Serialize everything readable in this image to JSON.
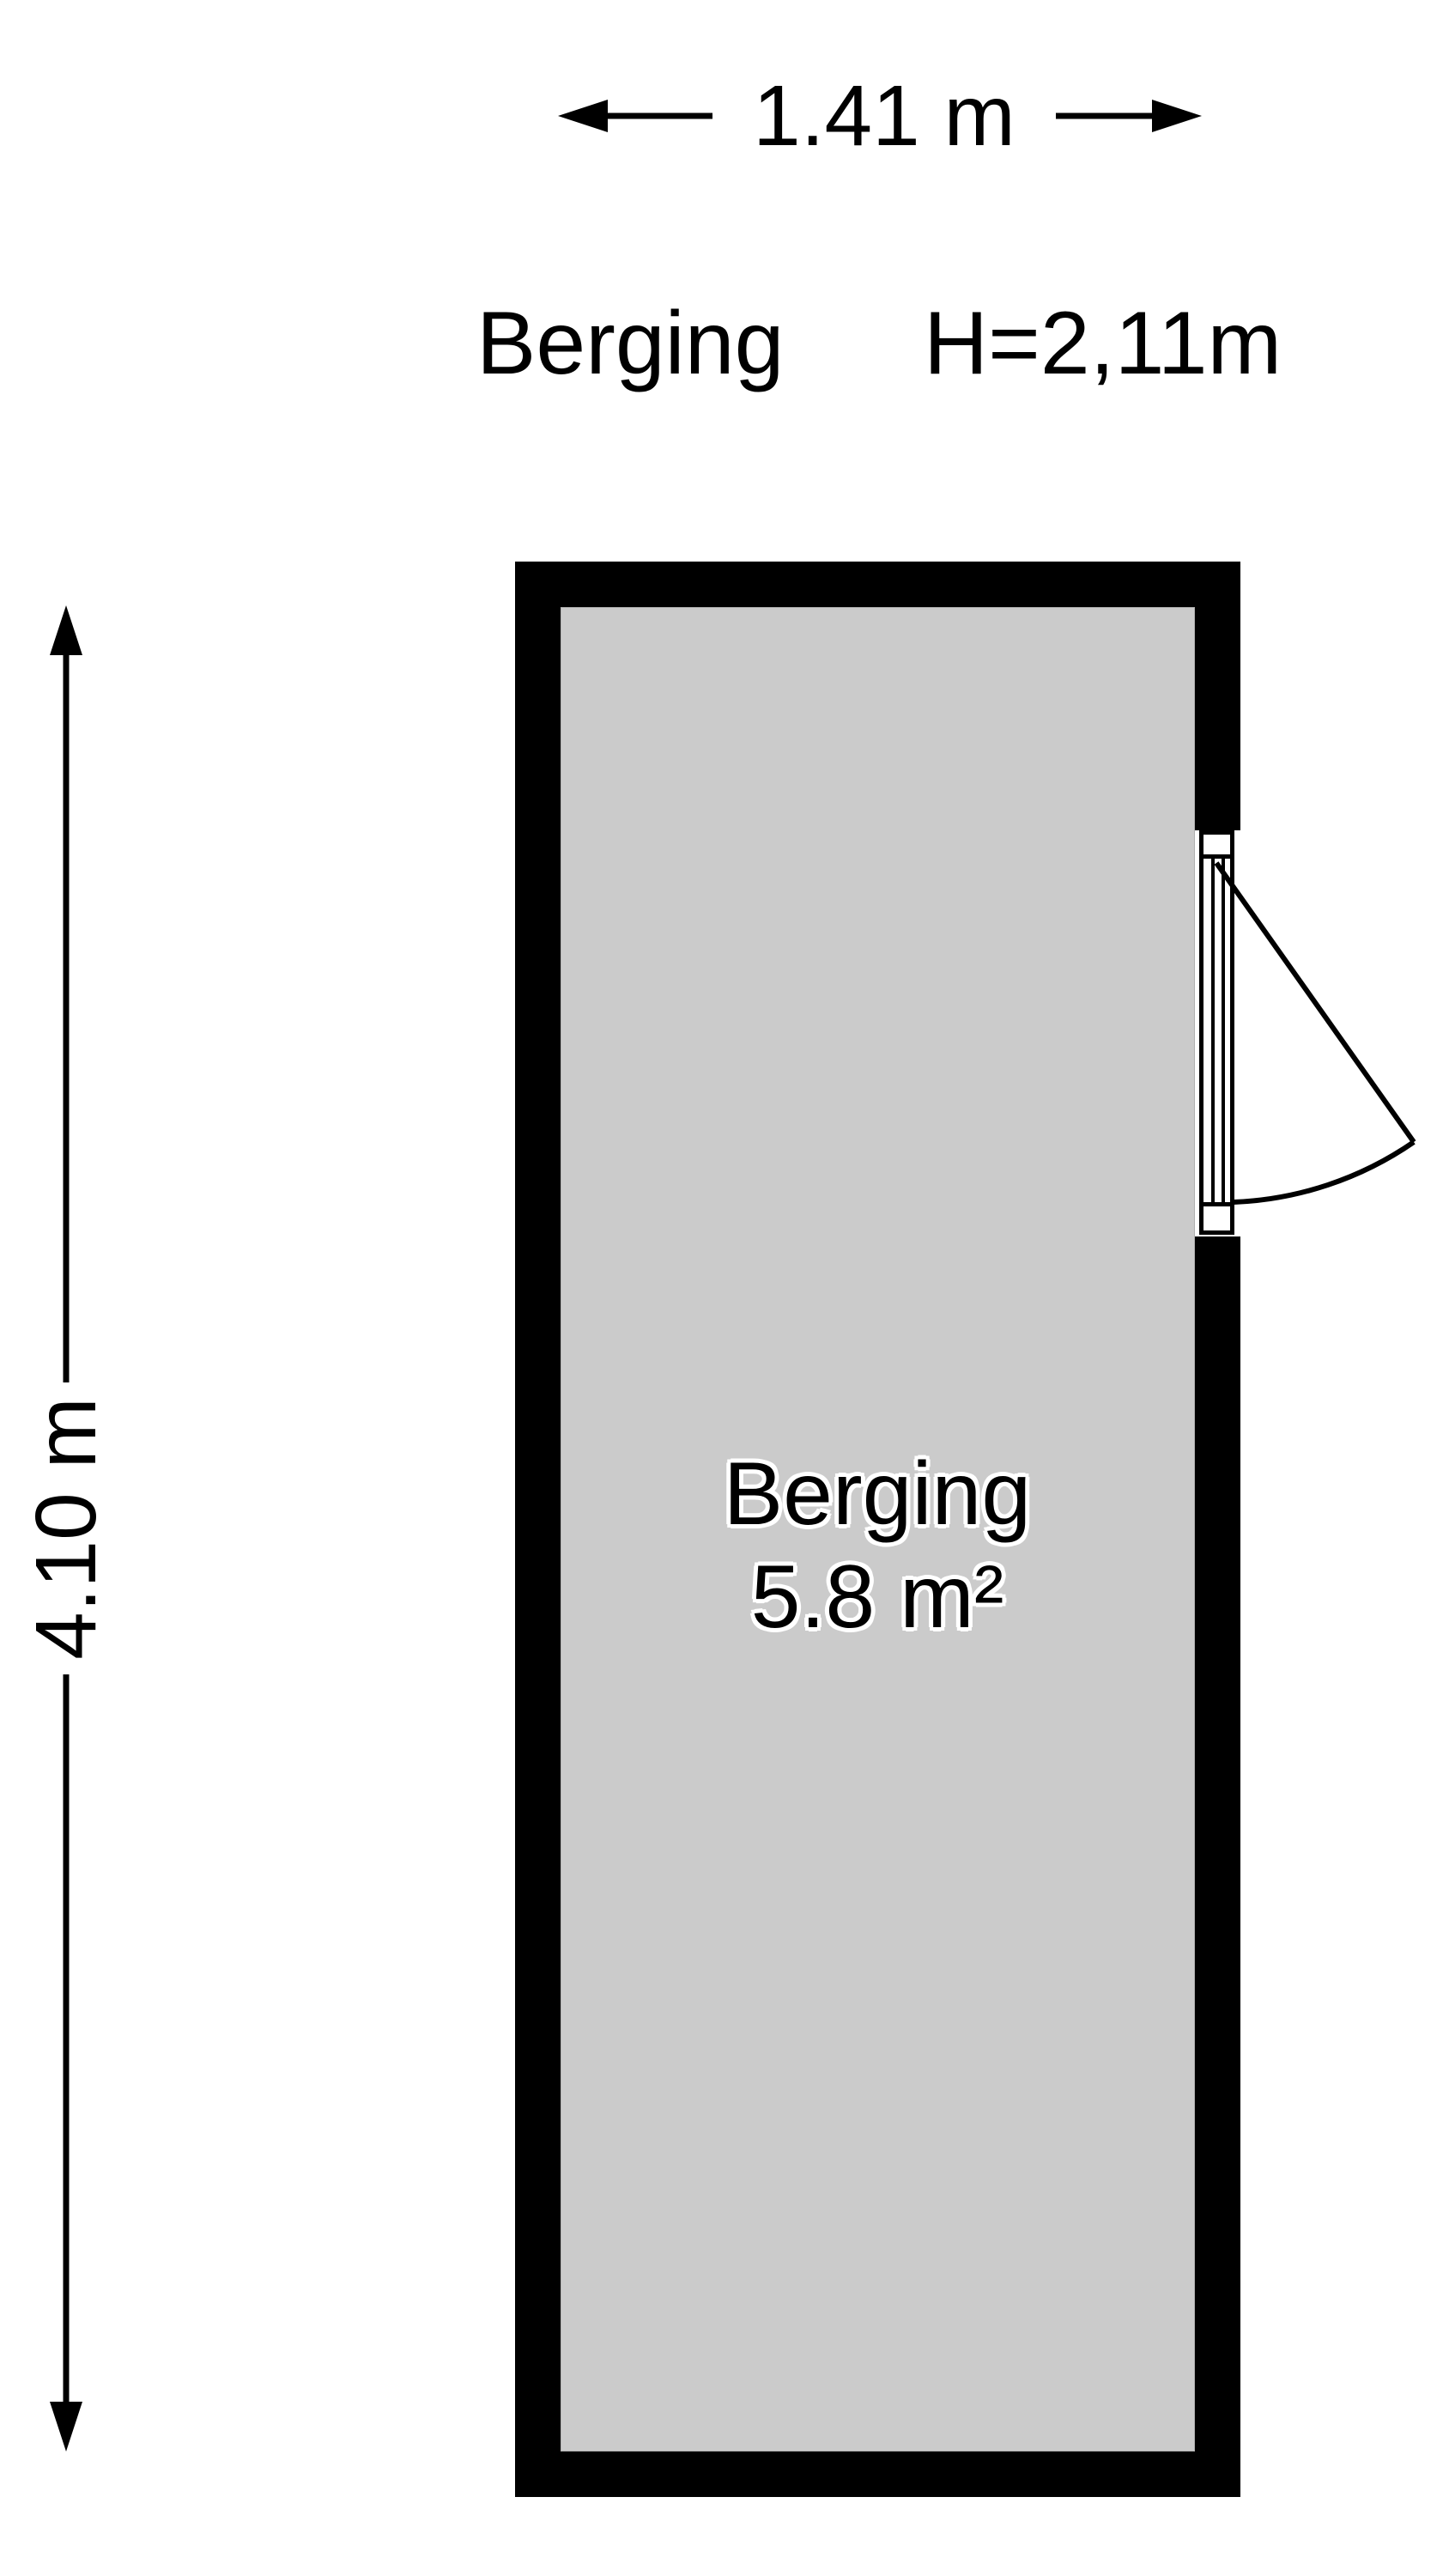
{
  "header": {
    "room_title": "Berging",
    "ceiling_height": "H=2,11m"
  },
  "dimensions": {
    "width_label": "1.41 m",
    "height_label": "4.10 m"
  },
  "room": {
    "name": "Berging",
    "area": "5.8 m²"
  },
  "colors": {
    "wall": "#000000",
    "floor": "#cbcbcb",
    "line": "#000000",
    "background": "#ffffff",
    "label_halo": "#ffffff"
  }
}
